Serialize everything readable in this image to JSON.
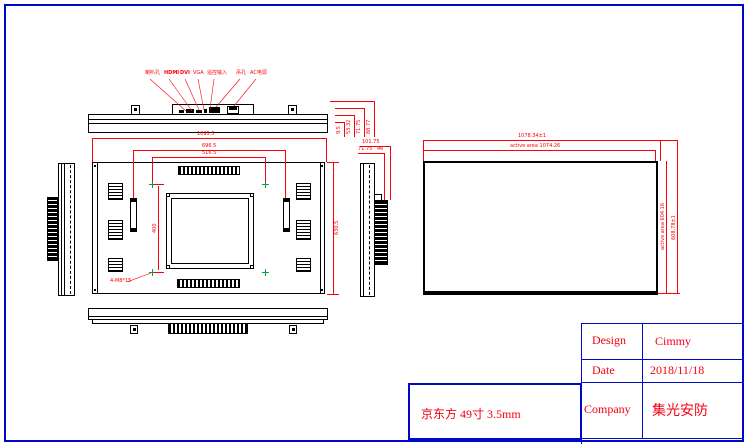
{
  "colors": {
    "line": "#000000",
    "dimension": "#fb0006",
    "frame": "#0008c8",
    "marker": "#00a33e",
    "text": "#f50013"
  },
  "drawing": {
    "product_label": "京东方 49寸 3.5mm",
    "title_block": {
      "rows": [
        {
          "label": "Design",
          "value": "Cimmy"
        },
        {
          "label": "Date",
          "value": "2018/11/18"
        },
        {
          "label": "Company",
          "value": "集光安防"
        }
      ]
    },
    "port_labels": [
      "喇叭孔",
      "HDMI",
      "DVI",
      "VGA",
      "遥控输入",
      "吊孔",
      "AC电源"
    ],
    "top_view": {
      "overall_width": "1095.5",
      "right_stack": [
        "9.5",
        "53.32",
        "71.75",
        "88.77"
      ]
    },
    "front_view": {
      "handle_span": "696.5",
      "mount_span_h": "516.5",
      "mount_span_v": "400",
      "mount_note": "4-M8*15",
      "overall_height": "630.5"
    },
    "side_view": {
      "depth_total": "101.75",
      "depth_body": "71.75",
      "depth_block": "46"
    },
    "screen_view": {
      "overall_width": "1078.34±1",
      "active_width": "active area 1074.26",
      "active_height": "active area 604.16",
      "overall_height": "608.78±1"
    }
  }
}
